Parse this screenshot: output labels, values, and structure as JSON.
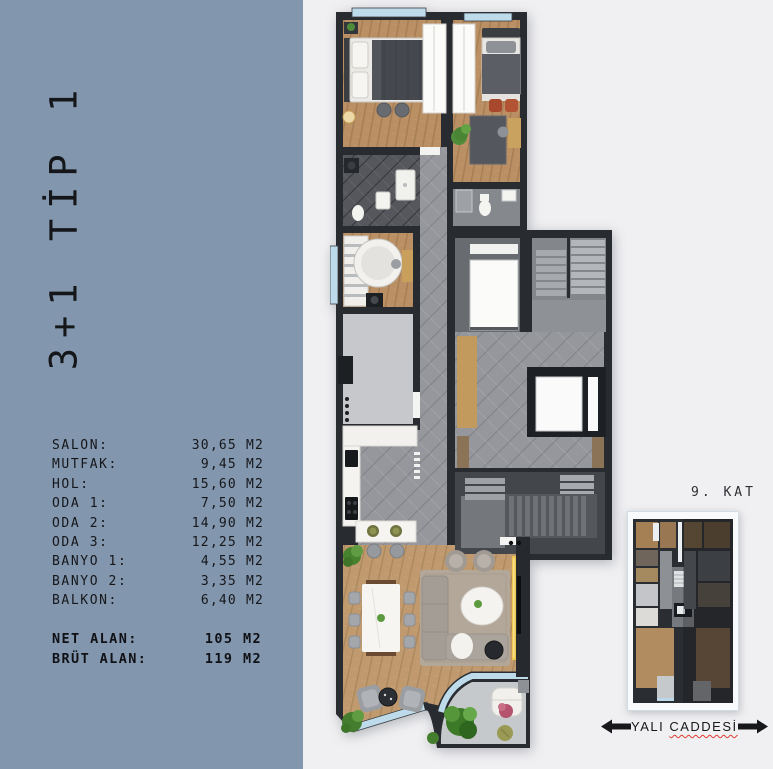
{
  "page": {
    "background": "#f0f0f2"
  },
  "panel": {
    "background": "#8296ad",
    "title": "3+1 TİP 1",
    "rooms": [
      {
        "label": "SALON:",
        "value": "30,65 M2"
      },
      {
        "label": "MUTFAK:",
        "value": "9,45 M2"
      },
      {
        "label": "HOL:",
        "value": "15,60 M2"
      },
      {
        "label": "ODA 1:",
        "value": "7,50 M2"
      },
      {
        "label": "ODA 2:",
        "value": "14,90 M2"
      },
      {
        "label": "ODA 3:",
        "value": "12,25 M2"
      },
      {
        "label": "BANYO 1:",
        "value": "4,55 M2"
      },
      {
        "label": "BANYO 2:",
        "value": "3,35 M2"
      },
      {
        "label": "BALKON:",
        "value": "6,40 M2"
      }
    ],
    "totals": [
      {
        "label": "NET ALAN:",
        "value": "105 M2"
      },
      {
        "label": "BRÜT ALAN:",
        "value": "119 M2"
      }
    ]
  },
  "key_plan": {
    "floor_label": "9. KAT"
  },
  "street": {
    "prefix": "YALI ",
    "underlined": "CADDESİ"
  },
  "colors": {
    "panel_blue": "#8296ad",
    "page_background": "#f0f0f2",
    "wall": "#282b30",
    "wood_floor": "#bd9669",
    "tile_gray": "#95979c",
    "glass_blue": "#bedbeb",
    "tv_glow_yellow": "#eec84e",
    "plant_green": "#4e8c3a",
    "chair_red": "#a8492e",
    "underline_red": "#e03a2f"
  }
}
